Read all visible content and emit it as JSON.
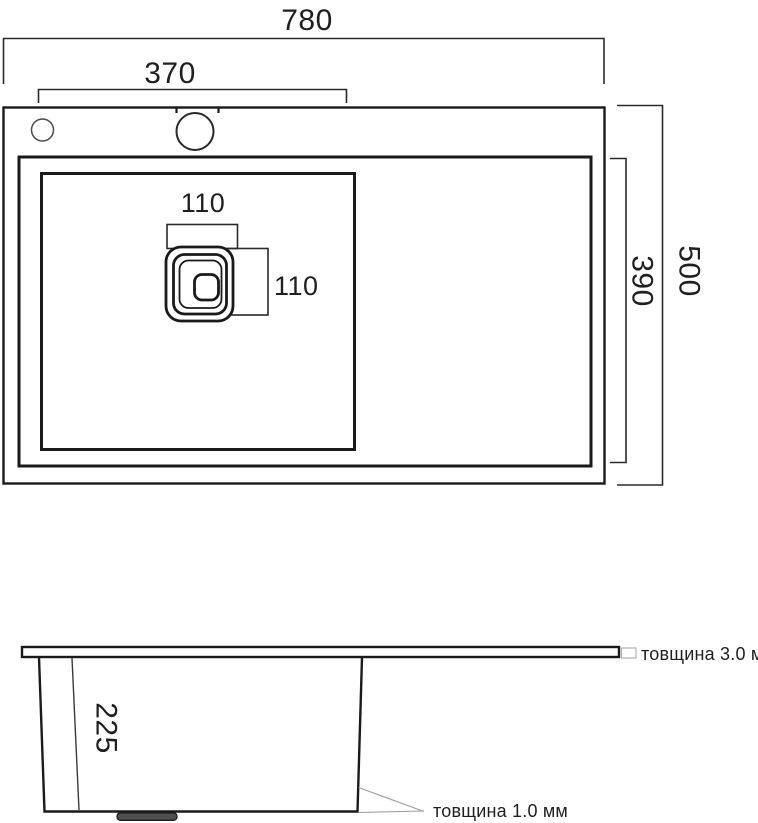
{
  "colors": {
    "ink": "#1a1a1a",
    "dim_line": "#2a2a2a",
    "leader_gray": "#9e9e9e",
    "drain_stub_fill": "#4f4f4f"
  },
  "top_view": {
    "overall_width_mm": "780",
    "bowl_width_mm": "370",
    "drain_width_mm": "110",
    "drain_height_mm": "110",
    "bowl_depth_mm": "390",
    "overall_depth_mm": "500"
  },
  "side_view": {
    "bowl_height_mm": "225",
    "top_thickness_note": "товщина 3.0 мм",
    "wall_thickness_note": "товщина 1.0 мм"
  }
}
